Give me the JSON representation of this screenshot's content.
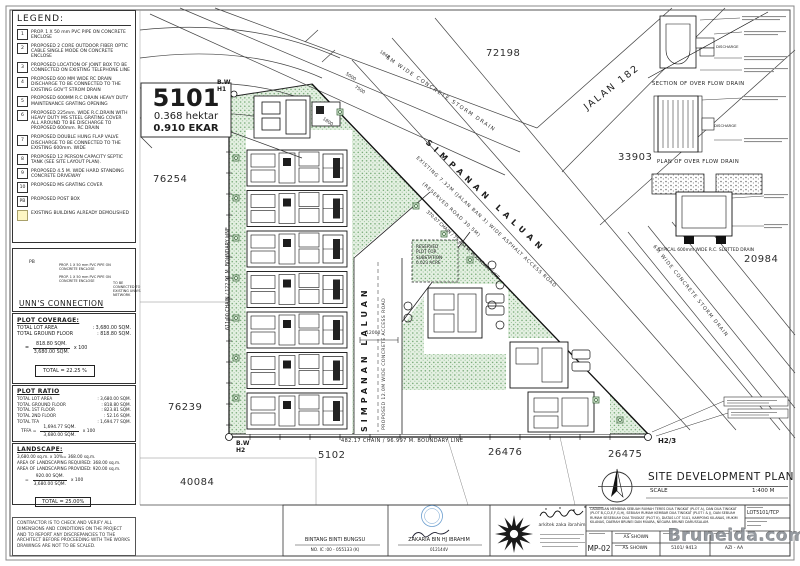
{
  "legend": {
    "title": "LEGEND:",
    "items": [
      {
        "key": "1",
        "text": "PROP. 1 X 50 mm PVC PIPE ON CONCRETE ENCLOSE"
      },
      {
        "key": "2",
        "text": "PROPOSED 2 CORE OUTDOOR FIBER OPTIC CABLE SINGLE MODE ON CONCRETE ENCLOSE"
      },
      {
        "key": "3",
        "text": "PROPOSED LOCATION OF JOINT BOX TO BE CONNECTED ON EXISTING TELEPHONE LINE"
      },
      {
        "key": "4",
        "text": "PROPOSED 600 MM WIDE RC DRAIN DISCHARGE TO BE CONNECTED TO THE EXISTING GOV'T STROM DRAIN"
      },
      {
        "key": "5",
        "text": "PROPOSED 600MM R.C DRAIN HEAVY DUTY MAINTENANCE GRATING OPENING"
      },
      {
        "key": "6",
        "text": "PROPOSED 225mm. WIDE R.C.DRAIN WITH HEAVY DUTY MS STEEL GRATING COVER ALL AROUND TO BE DISCHARGE TO PROPOSED 600mm. RC DRAIN"
      },
      {
        "key": "7",
        "text": "PROPOSED DOUBLE HUNG FLAP VALVE DISCHARGE TO BE CONNECTED TO THE EXISTING 600mm. WIDE"
      },
      {
        "key": "8",
        "text": "PROPOSED 12 PERSON CAPACITY SEPTIC TANK (SEE SITE LAYOUT PLAN)."
      },
      {
        "key": "9",
        "text": "PROPOSED 4.5 M. WIDE HARD STANDING CONCRETE DRIVEWAY"
      },
      {
        "key": "10",
        "text": "PROPOSED MS GRATING COVER"
      },
      {
        "key": "PB",
        "text": "PROPOSED POST BOX"
      },
      {
        "key": "",
        "text": "EXISTING BUILDING ALREADY DEMOLISHED"
      }
    ]
  },
  "unns": {
    "title": "UNN'S CONNECTION",
    "pb_label": "PB",
    "pipe_label_1": "PROP. 1 X 50 mm PVC PIPE ON CONCRETE ENCLOSE",
    "pipe_label_2": "PROP. 1 X 50 mm PVC PIPE ON CONCRETE ENCLOSE",
    "arrow_note": "TO BE CONNECTED TO EXISTING UNN'S NETWORK"
  },
  "plot_coverage": {
    "title": "PLOT COVERAGE:",
    "rows": [
      {
        "label": "TOTAL LOT AREA",
        "value": ":  3,680.00 SQM."
      },
      {
        "label": "TOTAL GROUND FLOOR",
        "value": ":  818.80 SQM."
      }
    ],
    "fraction": {
      "prefix": "=",
      "numerator": "818.80 SQM.",
      "denominator": "3,680.00 SQM.",
      "suffix": "x 100"
    },
    "result": "TOTAL  =  22.25 %"
  },
  "plot_ratio": {
    "title": "PLOT RATIO",
    "rows": [
      {
        "label": "TOTAL LOT AREA",
        "value": ":  3,680.00 SQM."
      },
      {
        "label": "TOTAL GROUND FLOOR",
        "value": ":  818.80 SQM."
      },
      {
        "label": "TOTAL 1ST FLOOR",
        "value": ":  823.81 SQM."
      },
      {
        "label": "TOTAL 2ND FLOOR",
        "value": ":  52.16 SQM."
      },
      {
        "label": "TOTAL TFA",
        "value": ":  1,694.77 SQM."
      }
    ],
    "fraction": {
      "prefix": "TFFA  =",
      "numerator": "1,694.77 SQM.",
      "denominator": "3,680.00 SQM.",
      "suffix": "x 100"
    },
    "result": "TFFA  =  46.05 %"
  },
  "landscape": {
    "title": "LANDSCAPE:",
    "lines": [
      "3,680.00 sq.m. x 10%= 368.00 sq.m.",
      "AREA OF LANDSCAPING REQUIRED: 368.00 sq.m.",
      "AREA OF LANDSCAPING PROVIDED: 920.00 sq.m."
    ],
    "fraction": {
      "prefix": "=",
      "numerator": "920.00 SQM.",
      "denominator": "3,680.00 SQM.",
      "suffix": "x 100"
    },
    "result": "TOTAL  =  25.00%"
  },
  "contractor_note": "CONTRACTOR IS TO CHECK AND VERIFY ALL DIMENSIONS AND CONDITIONS ON THE PROJECT AND TO REPORT ANY DISCREPANCIES TO THE ARCHITECT BEFORE PROCEEDING WITH THE WORKS DRAWINGS ARE NOT TO BE SCALED.",
  "plan": {
    "site_label": {
      "lot": "5101",
      "hektar": "0.368 hektar",
      "ekar": "0.910 EKAR"
    },
    "plot_numbers": {
      "p72198": "72198",
      "p76254": "76254",
      "p76239": "76239",
      "p40084": "40084",
      "p5102": "5102",
      "p26476": "26476",
      "p26475": "26475",
      "p33903": "33903",
      "p20984": "20984"
    },
    "roads": {
      "jalan182": "JALAN 182",
      "storm_top": "6M WIDE CONCRETE STORM DRAIN",
      "storm_right": "6M WIDE CONCRETE STORM DRAIN",
      "simpanan_diag": "SIMPANAN LALUAN",
      "simpanan_vert": "SIMPANAN LALUAN",
      "existing_road": "EXISTING 7.32M (JALAN BAN 3) WIDE ASPHALT ACCESS ROAD",
      "reserved_road": "(RESERVED ROAD 30.5M)",
      "proposed_road": "PROPOSED 12.0M WIDE CONCRETE ACCESS ROAD"
    },
    "boundaries": {
      "left": "611.00 CHAIN / 122.91 M. BOUNDARY LINE",
      "bottom": "482.17 CHAIN / 96.997 M. BOUNDARY LINE",
      "diagonal": "370.07 CHAIN / 75.434 M. BOUNDARY LINE"
    },
    "markers": {
      "bw": "B.W",
      "h1": "H1",
      "h2": "H2",
      "h23": "H2/3"
    },
    "substation_lines": [
      "RESERVED",
      "PLOT FOR",
      "SUBSTATION",
      "0.023 ACRE"
    ],
    "dims": {
      "d1848": "1848",
      "d5000": "5000",
      "d7500": "7500",
      "d1800": "1800",
      "d12000": "12000"
    },
    "details": {
      "section_title": "SECTION OF OVER FLOW DRAIN",
      "plan_title": "PLAN OF OVER FLOW DRAIN",
      "slotted_title": "TYPICAL 600mm WIDE R.C. SLOTTED DRAIN",
      "discharge1": "DISCHARGE",
      "discharge2": "DISCHARGE"
    },
    "title": "SITE DEVELOPMENT PLAN",
    "scale_label": "SCALE",
    "scale_value": "1:400 M"
  },
  "titleblock": {
    "sig1_name": "BINTANG BINTI BUNGSU",
    "sig1_id": "NO. IC :00 - 055133 (K)",
    "sig2_name": "ZAKARIA BIN HJ IBRAHIM",
    "sig2_id": "012144V",
    "firm": "arkitek zaka ibrahim",
    "project_desc": "CADANGAN MEMBINA SEBUAH RUMAH TERES DUA TINGKAT (PLOT A), DAN DUA TINGKAT (PLOT B,C,D,E,F,G,H), SEBUAH RUMAH KEMBAR DUA TINGKAT (PLOT I & J), DAN SEBUAH RUMAH SESEBUAH DUA TINGKAT (PLOT K), DIATAS LOT 5101, KAMPONG KILANAS, MUKIM KILANAS, DAERAH BRUNEI DAN MUARA, NEGARA BRUNEI DARUSSALAM.",
    "drawing_no": "MP-02",
    "scale1": "AS SHOWN",
    "scale2": "AS SHOWN",
    "project_no": "LOT5101/TCP",
    "ref_no": "5101/ 9413",
    "drawn_by": "AZI - AA"
  },
  "watermark": "Bruneida.com",
  "colors": {
    "site_green": "#e4f0e2",
    "site_dot": "#6da46d",
    "demolished_yellow": "#fdf6c3",
    "stamp_blue": "#6b9ecf",
    "ink": "#1c1c1c"
  }
}
